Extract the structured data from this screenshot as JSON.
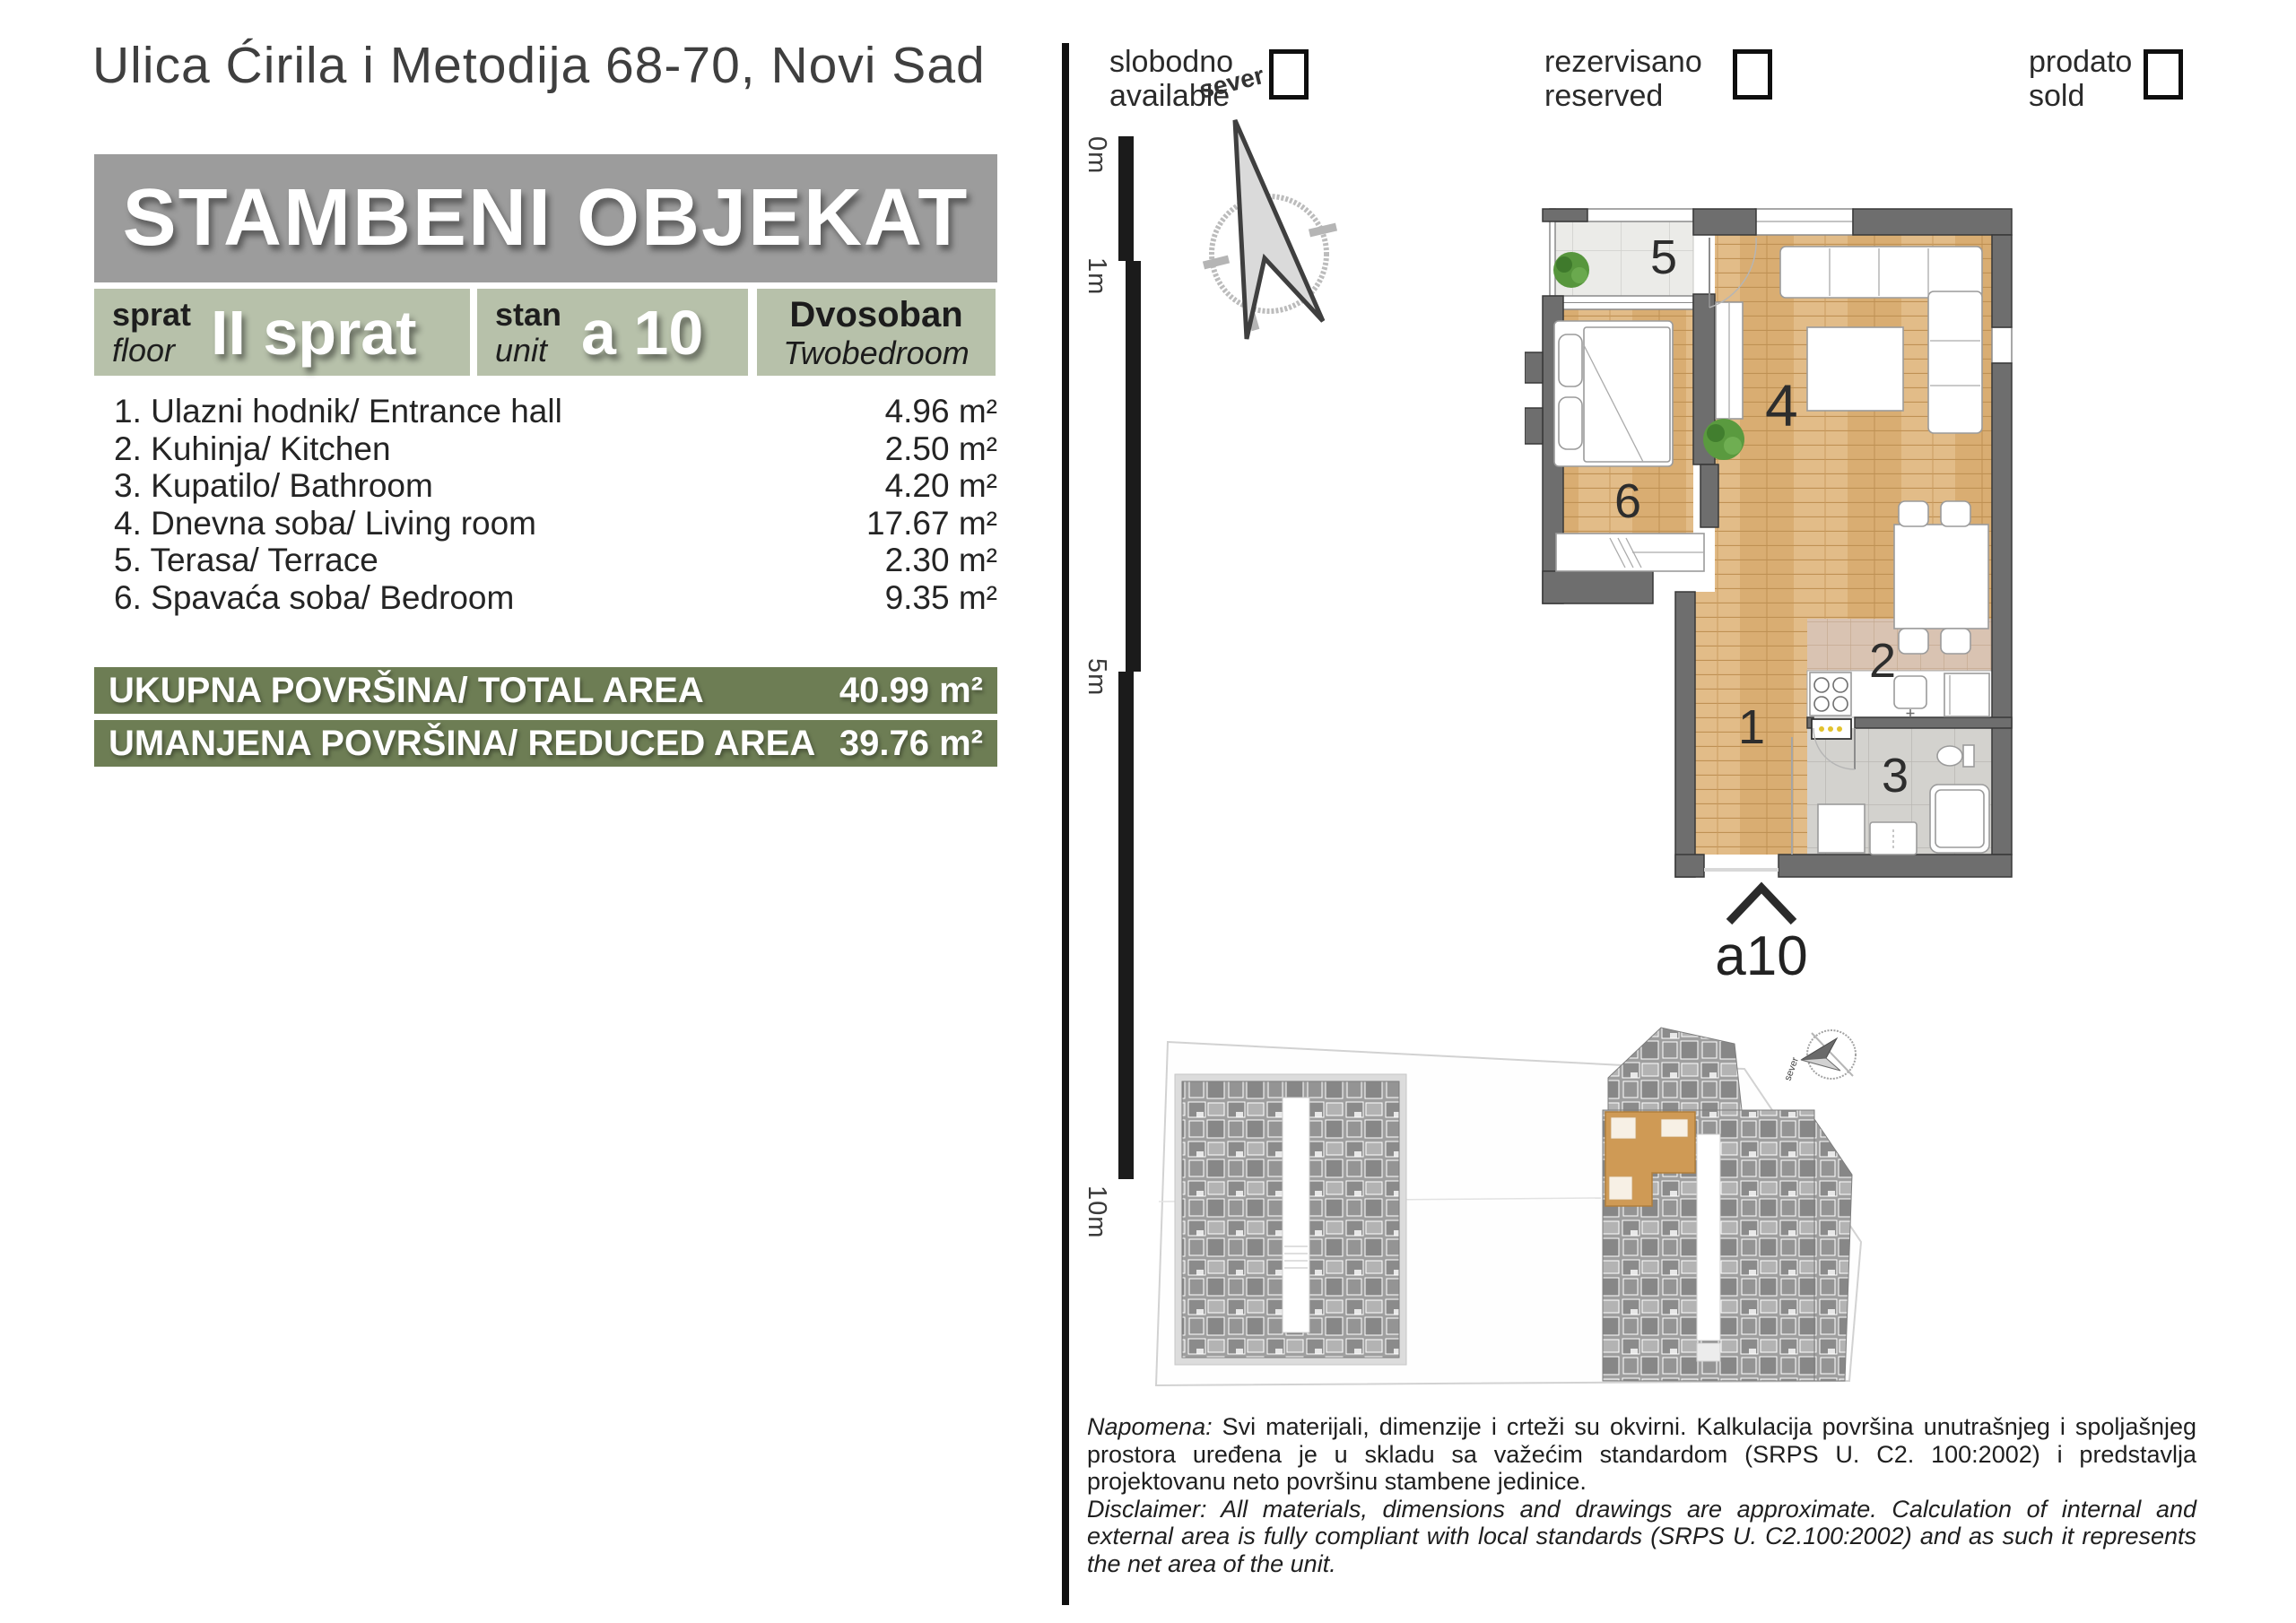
{
  "header": {
    "address": "Ulica Ćirila i Metodija 68-70, Novi Sad"
  },
  "banner": {
    "title": "STAMBENI OBJEKAT"
  },
  "unit_info": {
    "floor_label_sr": "sprat",
    "floor_label_en": "floor",
    "floor_value": "II sprat",
    "unit_label_sr": "stan",
    "unit_label_en": "unit",
    "unit_value": "a 10",
    "type_sr": "Dvosoban",
    "type_en": "Twobedroom"
  },
  "rooms": [
    {
      "name": "1. Ulazni hodnik/ Entrance hall",
      "area": "4.96 m²"
    },
    {
      "name": "2. Kuhinja/ Kitchen",
      "area": "2.50 m²"
    },
    {
      "name": "3. Kupatilo/ Bathroom",
      "area": "4.20 m²"
    },
    {
      "name": "4. Dnevna soba/ Living room",
      "area": "17.67 m²"
    },
    {
      "name": "5. Terasa/ Terrace",
      "area": "2.30 m²"
    },
    {
      "name": "6. Spavaća soba/ Bedroom",
      "area": "9.35 m²"
    }
  ],
  "totals": [
    {
      "label": "UKUPNA POVRŠINA/ TOTAL AREA",
      "value": "40.99 m²"
    },
    {
      "label": "UMANJENA POVRŠINA/ REDUCED AREA",
      "value": "39.76 m²"
    }
  ],
  "legend": [
    {
      "sr": "slobodno",
      "en": "available"
    },
    {
      "sr": "rezervisano",
      "en": "reserved"
    },
    {
      "sr": "prodato",
      "en": "sold"
    }
  ],
  "scale_bar": {
    "labels": [
      "0m",
      "1m",
      "5m",
      "10m"
    ]
  },
  "compass": {
    "label": "sever"
  },
  "plan": {
    "labels": {
      "entrance": "1",
      "kitchen": "2",
      "bathroom": "3",
      "living": "4",
      "terrace": "5",
      "bedroom": "6"
    },
    "unit_label": "a10"
  },
  "site": {
    "compass_label": "sever"
  },
  "disclaimer": {
    "sr_label": "Napomena:",
    "sr_text": " Svi materijali, dimenzije i crteži su okvirni. Kalkulacija površina unutrašnjeg i spoljašnjeg prostora uređena je u skladu sa važećim standardom (SRPS U. C2. 100:2002) i predstavlja projektovanu neto površinu stambene jedinice.",
    "en_label": "Disclaimer:",
    "en_text": " All materials, dimensions and drawings are approximate. Calculation of internal and external area is fully compliant with local standards (SRPS U. C2.100:2002) and as such it represents the net area of the unit."
  },
  "colors": {
    "banner_gray": "#9c9c9c",
    "sage": "#b7c1aa",
    "olive": "#6d7d54",
    "wall_gray": "#6e6e6e",
    "wood": "#dcb57e",
    "highlight_orange": "#cf9a55"
  }
}
